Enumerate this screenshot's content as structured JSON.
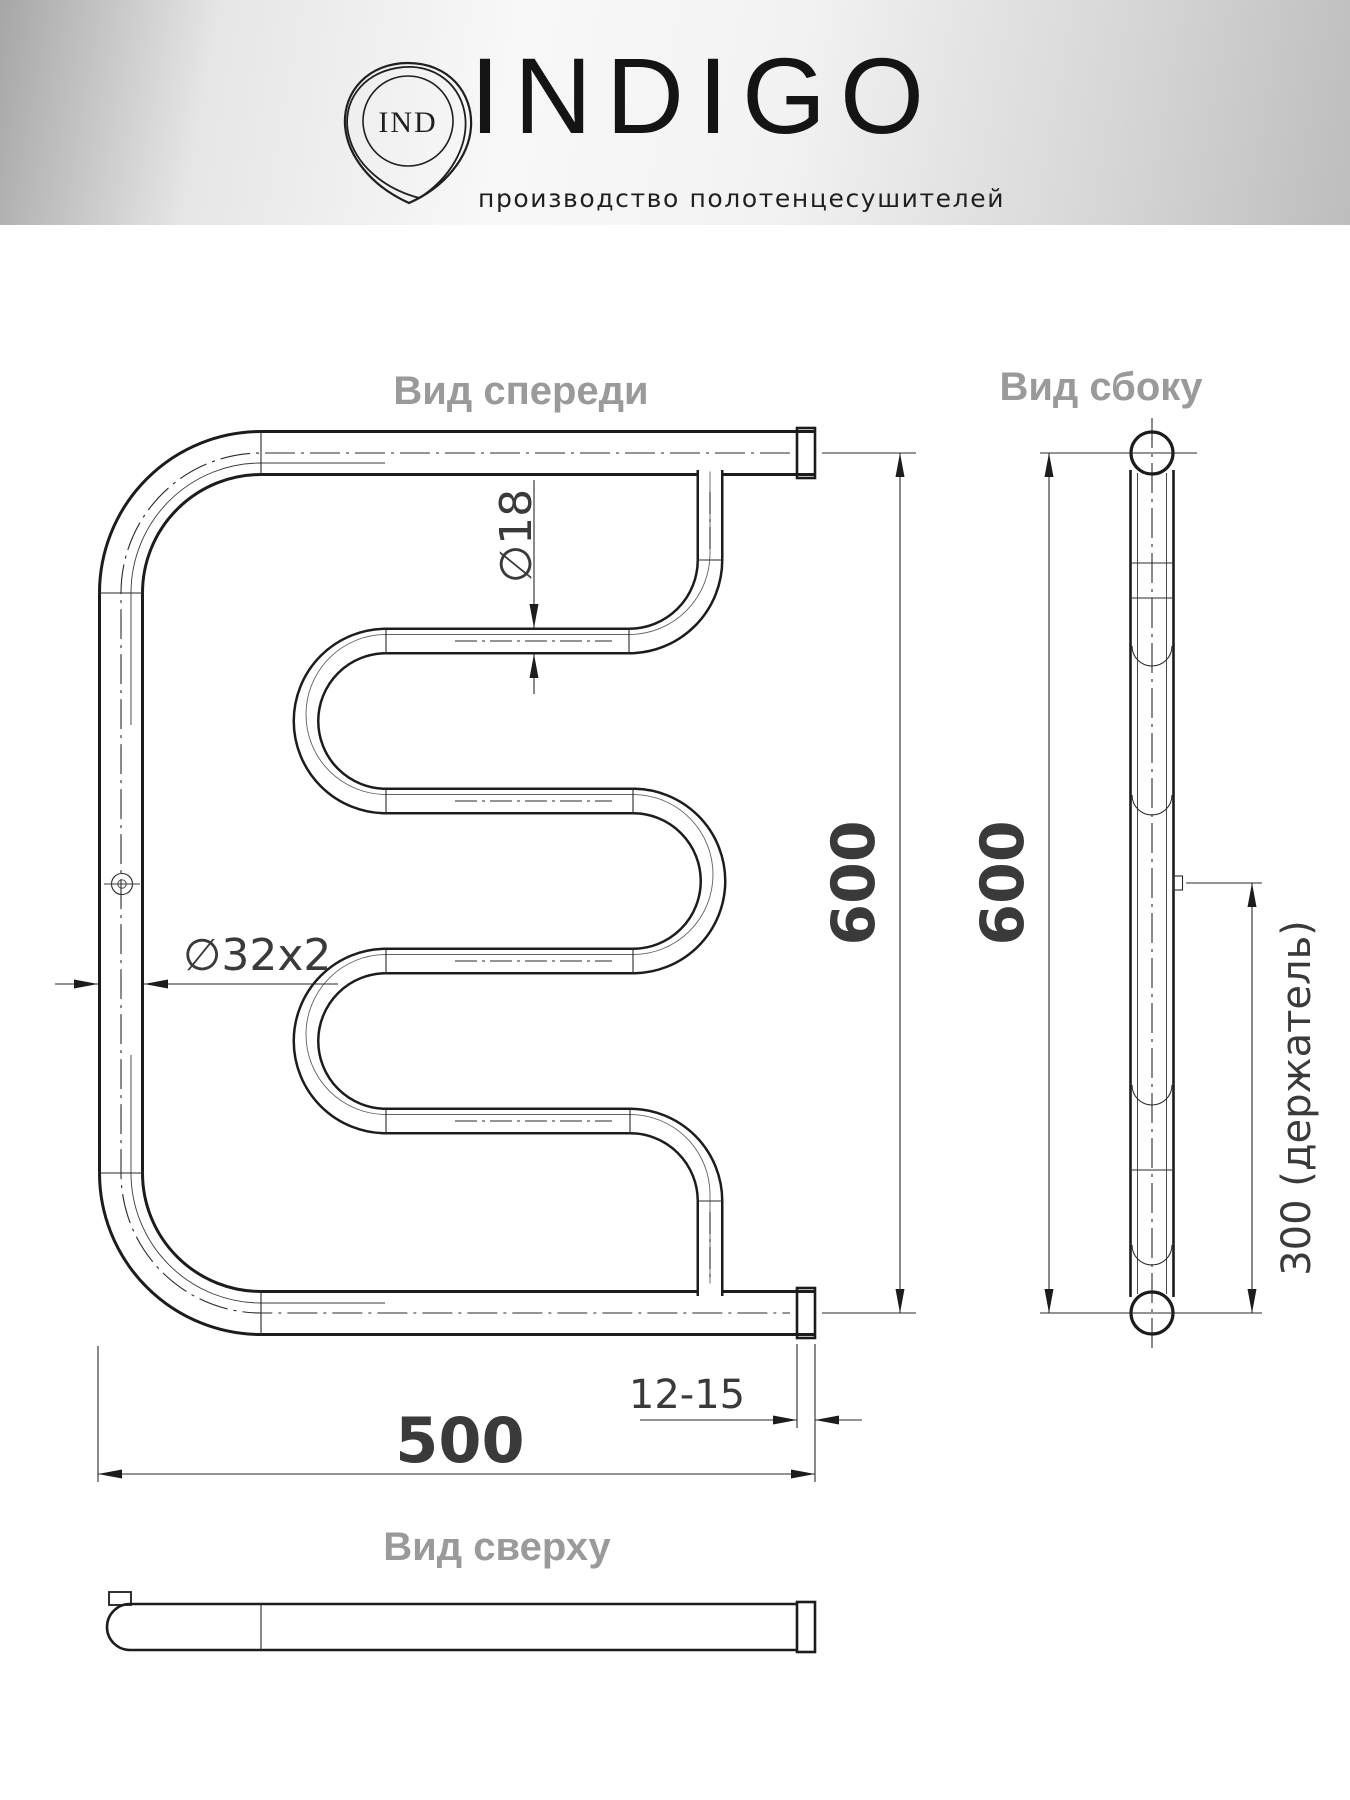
{
  "header": {
    "monogram": "IND",
    "brand": "INDIGO",
    "tagline": "производство полотенцесушителей"
  },
  "views": {
    "front": {
      "label": "Вид спереди"
    },
    "side": {
      "label": "Вид сбоку"
    },
    "top": {
      "label": "Вид сверху"
    }
  },
  "dimensions": {
    "front_height_mm": "600",
    "side_height_mm": "600",
    "width_mm": "500",
    "holder_spacing": "300 (держатель)",
    "wall_offset_mm": "12-15",
    "rail_tube_diameter": "∅18",
    "main_tube_diameter": "∅32x2"
  },
  "colors": {
    "line": "#1c1c1c",
    "dimension_text": "#3a3a3a",
    "view_label": "#9a9a9a",
    "header_gradient_left": "#a6a6a6",
    "header_gradient_center": "#f8f8f8",
    "header_gradient_right": "#bdbdbd"
  }
}
